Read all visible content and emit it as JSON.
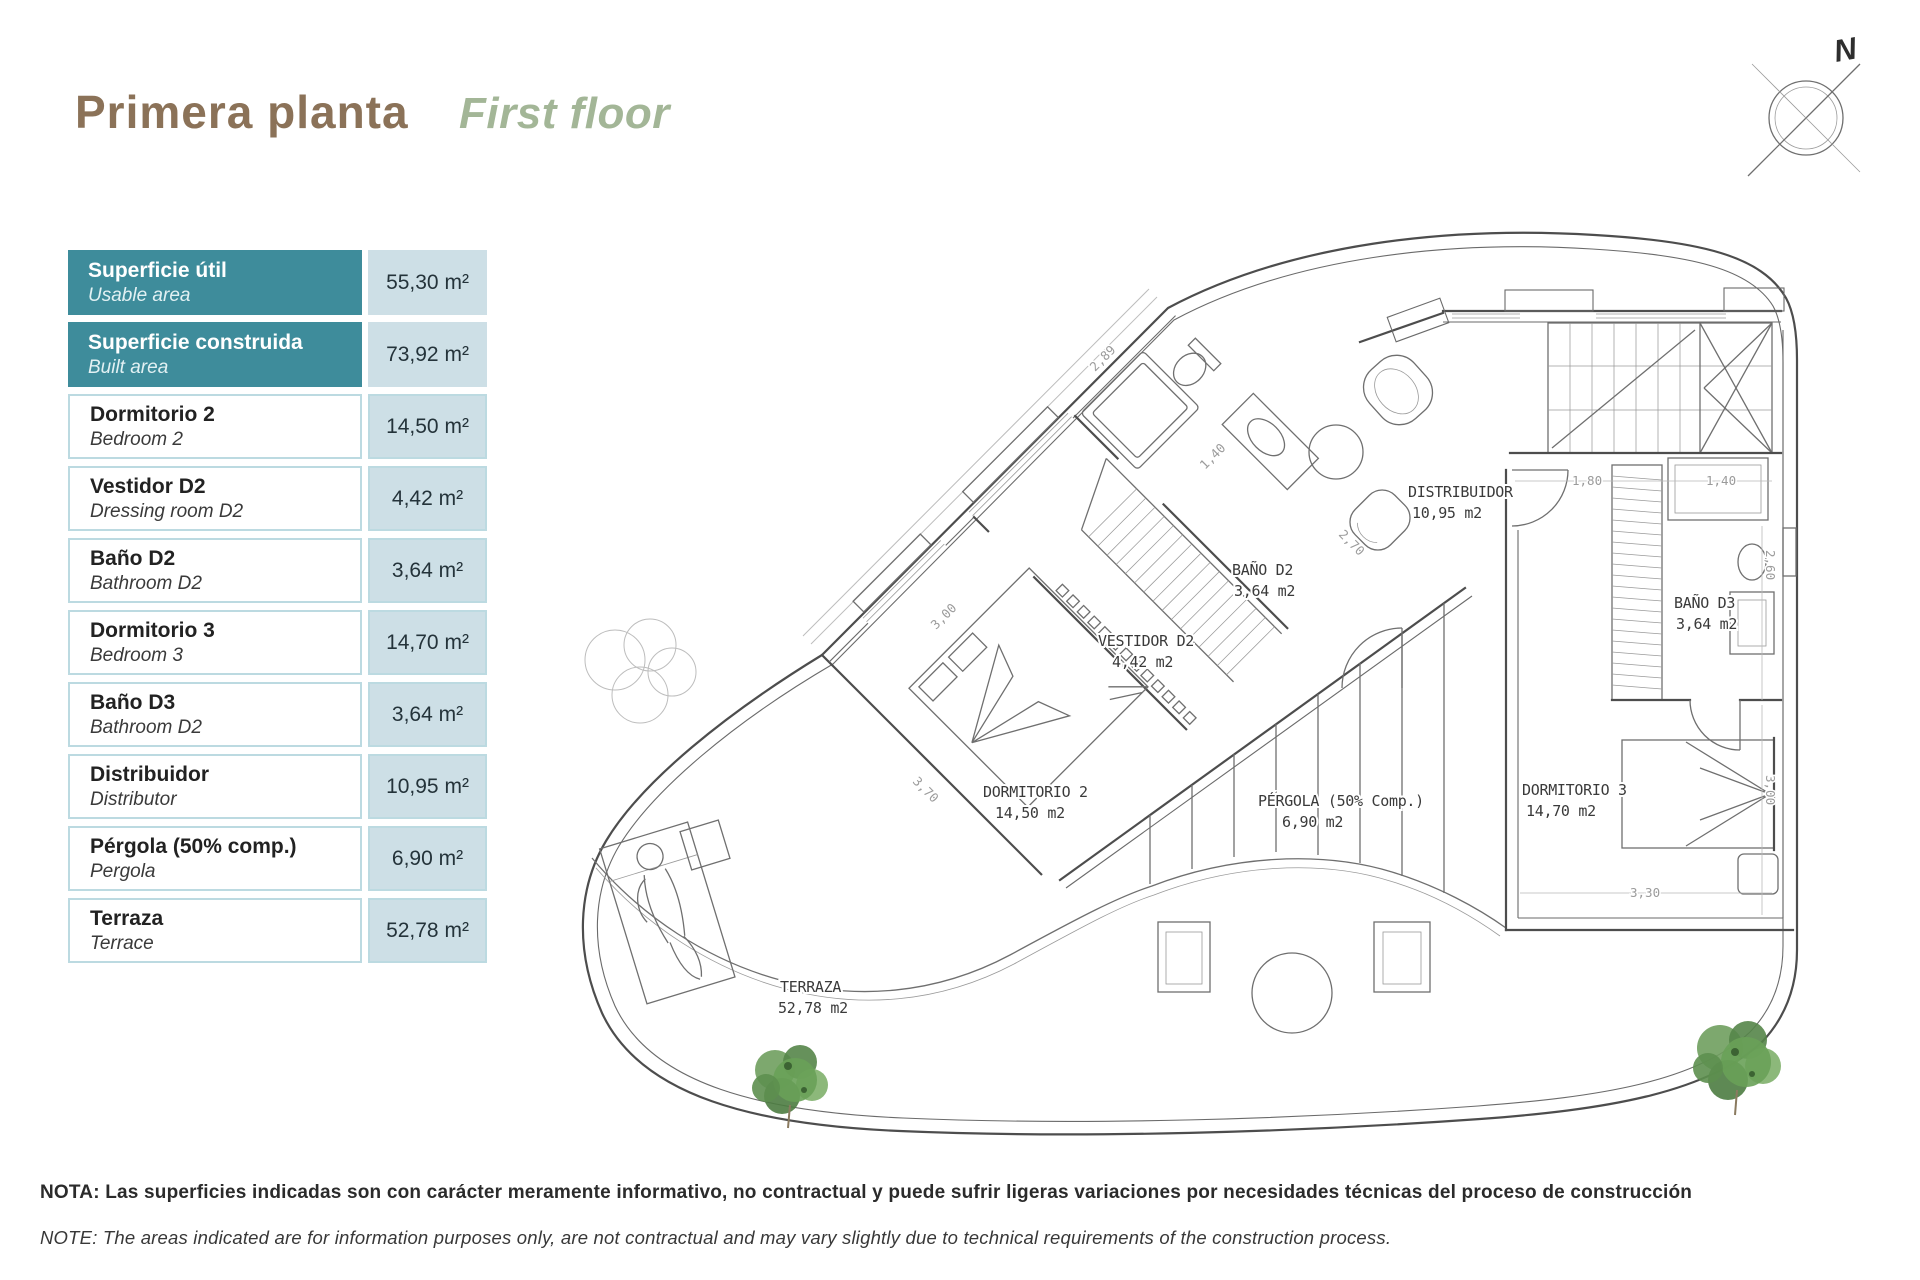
{
  "title": {
    "es": "Primera planta",
    "en": "First floor"
  },
  "compass": {
    "north_label": "N"
  },
  "table": {
    "rows": [
      {
        "es": "Superficie útil",
        "en": "Usable area",
        "value": "55,30 m²",
        "highlight": true
      },
      {
        "es": "Superficie construida",
        "en": "Built area",
        "value": "73,92 m²",
        "highlight": true
      },
      {
        "es": "Dormitorio 2",
        "en": "Bedroom 2",
        "value": "14,50 m²",
        "highlight": false
      },
      {
        "es": "Vestidor D2",
        "en": "Dressing room D2",
        "value": "4,42 m²",
        "highlight": false
      },
      {
        "es": "Baño D2",
        "en": "Bathroom D2",
        "value": "3,64 m²",
        "highlight": false
      },
      {
        "es": "Dormitorio 3",
        "en": "Bedroom 3",
        "value": "14,70 m²",
        "highlight": false
      },
      {
        "es": "Baño D3",
        "en": "Bathroom D2",
        "value": "3,64 m²",
        "highlight": false
      },
      {
        "es": "Distribuidor",
        "en": "Distributor",
        "value": "10,95 m²",
        "highlight": false
      },
      {
        "es": "Pérgola (50% comp.)",
        "en": "Pergola",
        "value": "6,90 m²",
        "highlight": false
      },
      {
        "es": "Terraza",
        "en": "Terrace",
        "value": "52,78 m²",
        "highlight": false
      }
    ]
  },
  "plan": {
    "rooms": [
      {
        "name": "DORMITORIO 2",
        "area": "14,50 m2"
      },
      {
        "name": "VESTIDOR D2",
        "area": "4,42 m2"
      },
      {
        "name": "BAÑO D2",
        "area": "3,64 m2"
      },
      {
        "name": "DISTRIBUIDOR",
        "area": "10,95 m2"
      },
      {
        "name": "BAÑO D3",
        "area": "3,64 m2"
      },
      {
        "name": "DORMITORIO 3",
        "area": "14,70 m2"
      },
      {
        "name": "PÉRGOLA (50% Comp.)",
        "area": "6,90 m2"
      },
      {
        "name": "TERRAZA",
        "area": "52,78 m2"
      }
    ],
    "dimensions": [
      "2,89",
      "1,40",
      "2,70",
      "3,00",
      "3,70",
      "1,80",
      "1,40",
      "2,60",
      "3,00",
      "3,30"
    ]
  },
  "notes": {
    "es": "NOTA: Las superficies indicadas son con carácter meramente informativo, no contractual y puede sufrir ligeras variaciones por necesidades técnicas del proceso de construcción",
    "en": "NOTE: The areas indicated are for information purposes only, are not contractual and may vary slightly due to technical requirements of the construction process."
  },
  "colors": {
    "title_primary": "#8B7258",
    "title_secondary": "#A3B697",
    "table_header_bg": "#3E8C9B",
    "table_value_bg": "#CDDFE6",
    "table_border": "#BCDAE1",
    "plan_line": "#4d4d4d",
    "tree_green": "#6f9e5e"
  }
}
